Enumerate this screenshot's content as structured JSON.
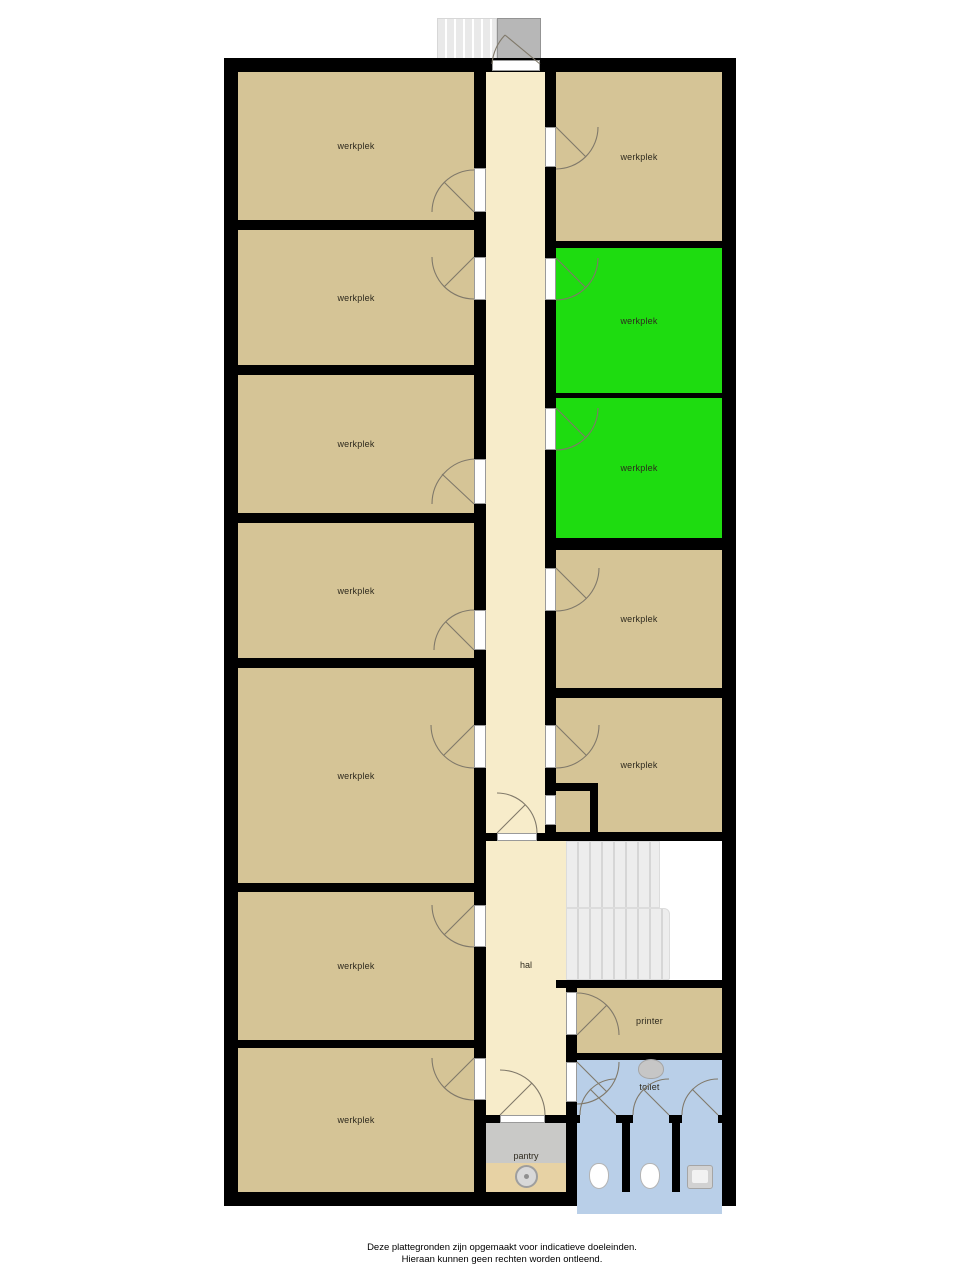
{
  "title": "plattegrond",
  "rooms": {
    "left": [
      {
        "label": "werkplek"
      },
      {
        "label": "werkplek"
      },
      {
        "label": "werkplek"
      },
      {
        "label": "werkplek"
      },
      {
        "label": "werkplek"
      },
      {
        "label": "werkplek"
      },
      {
        "label": "werkplek"
      }
    ],
    "right": [
      {
        "label": "werkplek",
        "highlighted": false
      },
      {
        "label": "werkplek",
        "highlighted": true
      },
      {
        "label": "werkplek",
        "highlighted": true
      },
      {
        "label": "werkplek",
        "highlighted": false
      },
      {
        "label": "werkplek",
        "highlighted": false
      }
    ],
    "hall": {
      "label": "hal"
    },
    "printer": {
      "label": "printer"
    },
    "toilet": {
      "label": "toilet"
    },
    "pantry": {
      "label": "pantry"
    }
  },
  "fixtures": {
    "stairs_interior": "striped-steps",
    "stairs_entrance": "striped-steps",
    "entrance_landing": "gray-square",
    "toilet_bowls": 2,
    "urinal": 1,
    "washbasin": "oval",
    "pantry_sink": "round"
  },
  "colors": {
    "wall": "#000000",
    "room": "#d5c496",
    "hall": "#f7ecca",
    "highlight": "#1edc10",
    "wet": "#b9cfe8",
    "pantry_counter": "#c9c9c7",
    "pantry_wood": "#e7d2a4",
    "stairline": "#d6d6d6",
    "landing": "#b7b7b7",
    "label": "#2e2a1e",
    "swing": "#80796a"
  },
  "footer": {
    "line1": "Deze plattegronden zijn opgemaakt voor indicatieve doeleinden.",
    "line2": "Hieraan kunnen geen rechten worden ontleend."
  }
}
